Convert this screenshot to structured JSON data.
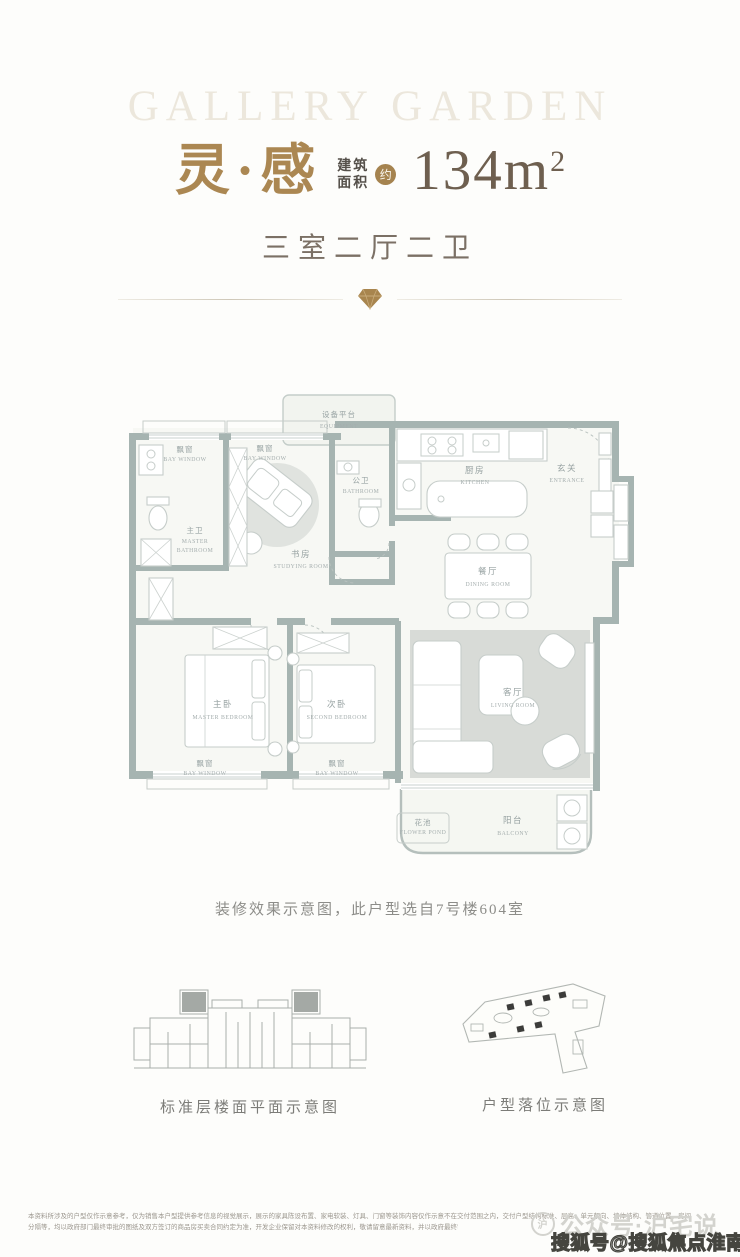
{
  "colors": {
    "accent_gold": "#a5834f",
    "title_gold": "#ab8752",
    "area_number": "#6e5f4f",
    "wall": "#a6b4b1",
    "living_rug": "#d8dbd7",
    "label_gray": "#96a1a1"
  },
  "header": {
    "watermark": "GALLERY GARDEN",
    "title": "灵·感",
    "area_prefix_line1": "建筑",
    "area_prefix_line2": "面积",
    "area_badge": "约",
    "area_value": "134m",
    "area_sup": "2",
    "subtitle": "三室二厅二卫"
  },
  "plan": {
    "caption": "装修效果示意图，此户型选自7号楼604室",
    "rooms": {
      "equipment": {
        "zh": "设备平台",
        "en": "EQUIPMENT"
      },
      "bay_tl1": {
        "zh": "飘窗",
        "en": "BAY WINDOW"
      },
      "bay_tl2": {
        "zh": "飘窗",
        "en": "BAY WINDOW"
      },
      "master_bath": {
        "zh": "主卫",
        "en1": "MASTER",
        "en2": "BATHROOM"
      },
      "study": {
        "zh": "书房",
        "en": "STUDYING ROOM"
      },
      "public_bath": {
        "zh": "公卫",
        "en": "BATHROOM"
      },
      "kitchen": {
        "zh": "厨房",
        "en": "KITCHEN"
      },
      "entrance": {
        "zh": "玄关",
        "en": "ENTRANCE"
      },
      "dining": {
        "zh": "餐厅",
        "en": "DINING ROOM"
      },
      "master_bed": {
        "zh": "主卧",
        "en": "MASTER BEDROOM"
      },
      "second_bed": {
        "zh": "次卧",
        "en": "SECOND BEDROOM"
      },
      "bay_bl1": {
        "zh": "飘窗",
        "en": "BAY WINDOW"
      },
      "bay_bl2": {
        "zh": "飘窗",
        "en": "BAY WINDOW"
      },
      "living": {
        "zh": "客厅",
        "en": "LIVING ROOM"
      },
      "flower_pond": {
        "zh": "花池",
        "en": "FLOWER POND"
      },
      "balcony": {
        "zh": "阳台",
        "en": "BALCONY"
      }
    }
  },
  "diagrams": {
    "floor_caption": "标准层楼面平面示意图",
    "site_caption": "户型落位示意图"
  },
  "footer": {
    "disclaimer_line1": "本资料所涉及的户型仅作示意参考，仅为销售本户型提供参考信息的视觉展示，展示的家具陈设布置、家电软装、灯具、门窗等装饰内容仅作示意不在交付范围之内，交付户型结构标准、层高、单元朝向、墙体结构、管道位置、房间",
    "disclaimer_line2": "分隔等，均以政府部门最终审批的图纸及双方签订的商品房买卖合同约定为准，开发企业保留对本资料修改的权利，敬请留意最新资料，并以政府最终审批文件为准。"
  },
  "watermarks": {
    "faint_logo": "沪",
    "faint": "公众号·沪宅说",
    "bold": "搜狐号@搜狐焦点淮南站"
  }
}
